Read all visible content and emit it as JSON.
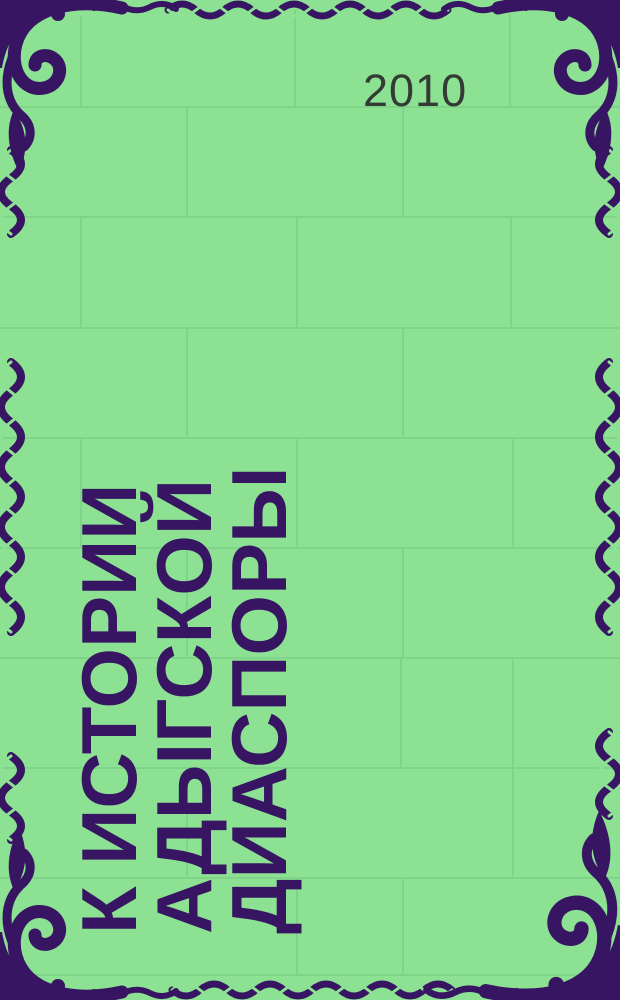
{
  "cover": {
    "year": "2010",
    "title_lines": [
      "К ИСТОРИИ",
      "АДЫГСКОЙ",
      "ДИАСПОРЫ"
    ],
    "title_full": "К истории адыгской диаспоры",
    "ornament_style": "dark-purple acanthus corner flourishes with twisted vine borders",
    "colors": {
      "background": "#8CE193",
      "grid_line": "#7DD288",
      "ornament": "#371563",
      "title_text": "#371563",
      "year_text": "#343B34"
    }
  }
}
